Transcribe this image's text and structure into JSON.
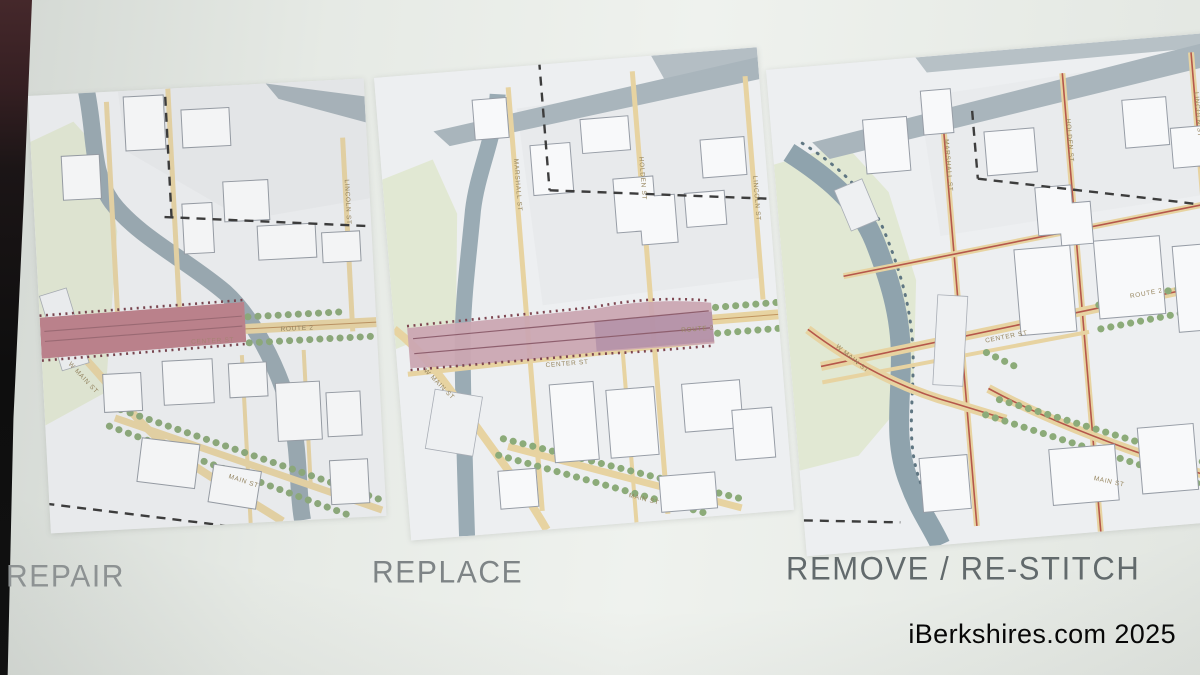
{
  "slide": {
    "options": [
      {
        "id": "repair",
        "label": "REPAIR"
      },
      {
        "id": "replace",
        "label": "REPLACE"
      },
      {
        "id": "restitch",
        "label": "REMOVE / RE-STITCH"
      }
    ],
    "watermark": "iBerkshires.com 2025"
  },
  "maps": {
    "repair": {
      "streets": {
        "route2": "ROUTE 2",
        "center": "CENTER ST",
        "lincoln": "LINCOLN ST",
        "wmain": "W MAIN ST",
        "main": "MAIN ST"
      }
    },
    "replace": {
      "streets": {
        "marshall": "MARSHALL ST",
        "holden": "HOLDEN ST",
        "lincoln": "LINCOLN ST",
        "center": "CENTER ST",
        "route2": "ROUTE 2",
        "wmain": "W MAIN ST",
        "main": "MAIN ST"
      }
    },
    "restitch": {
      "streets": {
        "marshall": "MARSHALL ST",
        "holden": "HOLDEN ST",
        "lincoln": "LINCOLN ST",
        "center": "CENTER ST",
        "route2": "ROUTE 2",
        "wmain": "W MAIN ST",
        "main": "MAIN ST"
      }
    }
  },
  "colors": {
    "overpass_repair": "#c2838d",
    "overpass_replace": "#cba6b2",
    "river": "#9aabb4",
    "road": "#e7d3a1",
    "restitch_line": "#b5574b",
    "green": "#8cab79",
    "label_gray": "#82878a"
  }
}
